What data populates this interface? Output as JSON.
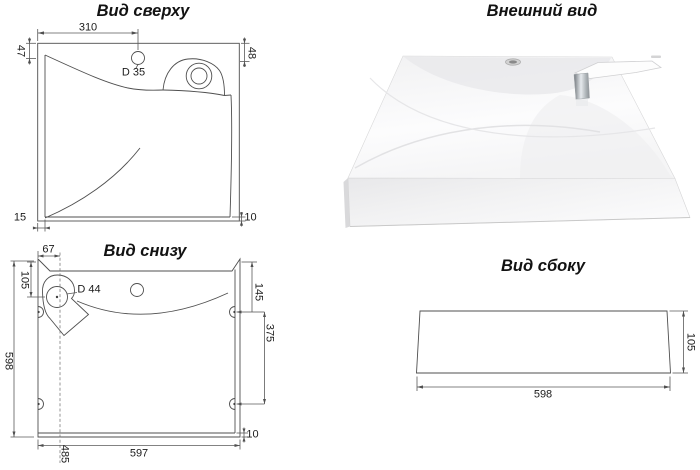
{
  "colors": {
    "background": "#ffffff",
    "line": "#4f4f4f",
    "text": "#1b1b1b"
  },
  "top_view": {
    "title": "Вид сверху",
    "dims": {
      "hole_offset": "310",
      "rim_left": "47",
      "rim_right": "48",
      "hole_diameter": "D 35",
      "edge_bottom_left": "15",
      "edge_bottom_right": "10"
    }
  },
  "external_view": {
    "title": "Внешний вид"
  },
  "bottom_view": {
    "title": "Вид снизу",
    "dims": {
      "drain_offset_x": "67",
      "drain_offset_y": "105",
      "drain_diameter": "D 44",
      "mount_hole_offset": "145",
      "mount_hole_spacing": "375",
      "overall_depth": "598",
      "overall_width": "597",
      "drain_centerline": "485",
      "rim_thickness": "10"
    }
  },
  "side_view": {
    "title": "Вид сбоку",
    "dims": {
      "width": "598",
      "height": "105"
    }
  }
}
